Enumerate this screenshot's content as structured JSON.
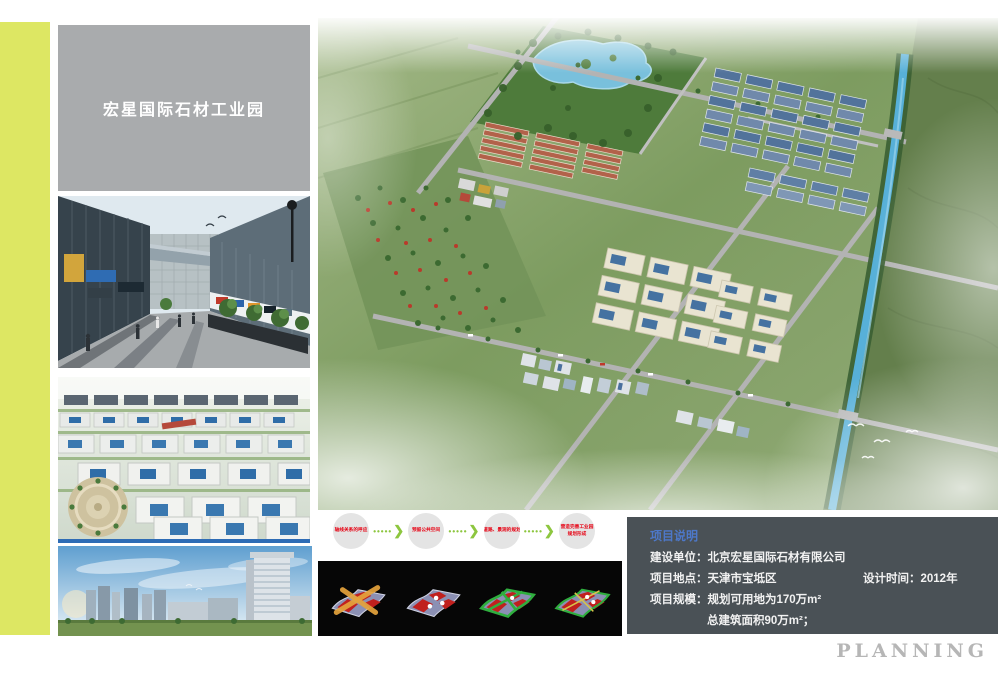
{
  "title_box": {
    "text": "宏星国际石材工业园",
    "bg_color": "#a9abad",
    "text_color": "#ffffff"
  },
  "accent": {
    "stripe_color": "#dde763"
  },
  "media": {
    "photo1": "street-view-rendering",
    "photo2": "industrial-park-aerial-rendering",
    "photo3": "city-skyline-rendering",
    "main": "master-plan-aerial-rendering"
  },
  "flow": {
    "arrow_dots": "•••••",
    "arrow_chevron": "❯",
    "arrow_color": "#8dc63f",
    "step_text_color": "#e60012",
    "steps": [
      {
        "label": "轴线关系的呼应"
      },
      {
        "label": "预留公共空间"
      },
      {
        "label": "道路、景观的规划"
      },
      {
        "label": "营造完善工业园",
        "label2": "规划形成"
      }
    ]
  },
  "concept_strip": {
    "bg_color": "#060606",
    "diagrams": [
      "concept-axis-cross",
      "concept-site-nodes",
      "concept-green-network",
      "concept-integrated-plan"
    ]
  },
  "project_info": {
    "header": "项目说明",
    "header_color": "#4d78c9",
    "panel_color": "#4a5156",
    "rows": [
      {
        "label": "建设单位：",
        "value": "北京宏星国际石材有限公司"
      },
      {
        "label": "项目地点：",
        "value": "天津市宝坻区",
        "label2": "设计时间：",
        "value2": "2012年"
      },
      {
        "label": "项目规模：",
        "value": "规划可用地为170万m²"
      },
      {
        "value": "总建筑面积90万m²；"
      }
    ]
  },
  "footer": {
    "label": "PLANNING",
    "color": "#b6b6b6"
  }
}
